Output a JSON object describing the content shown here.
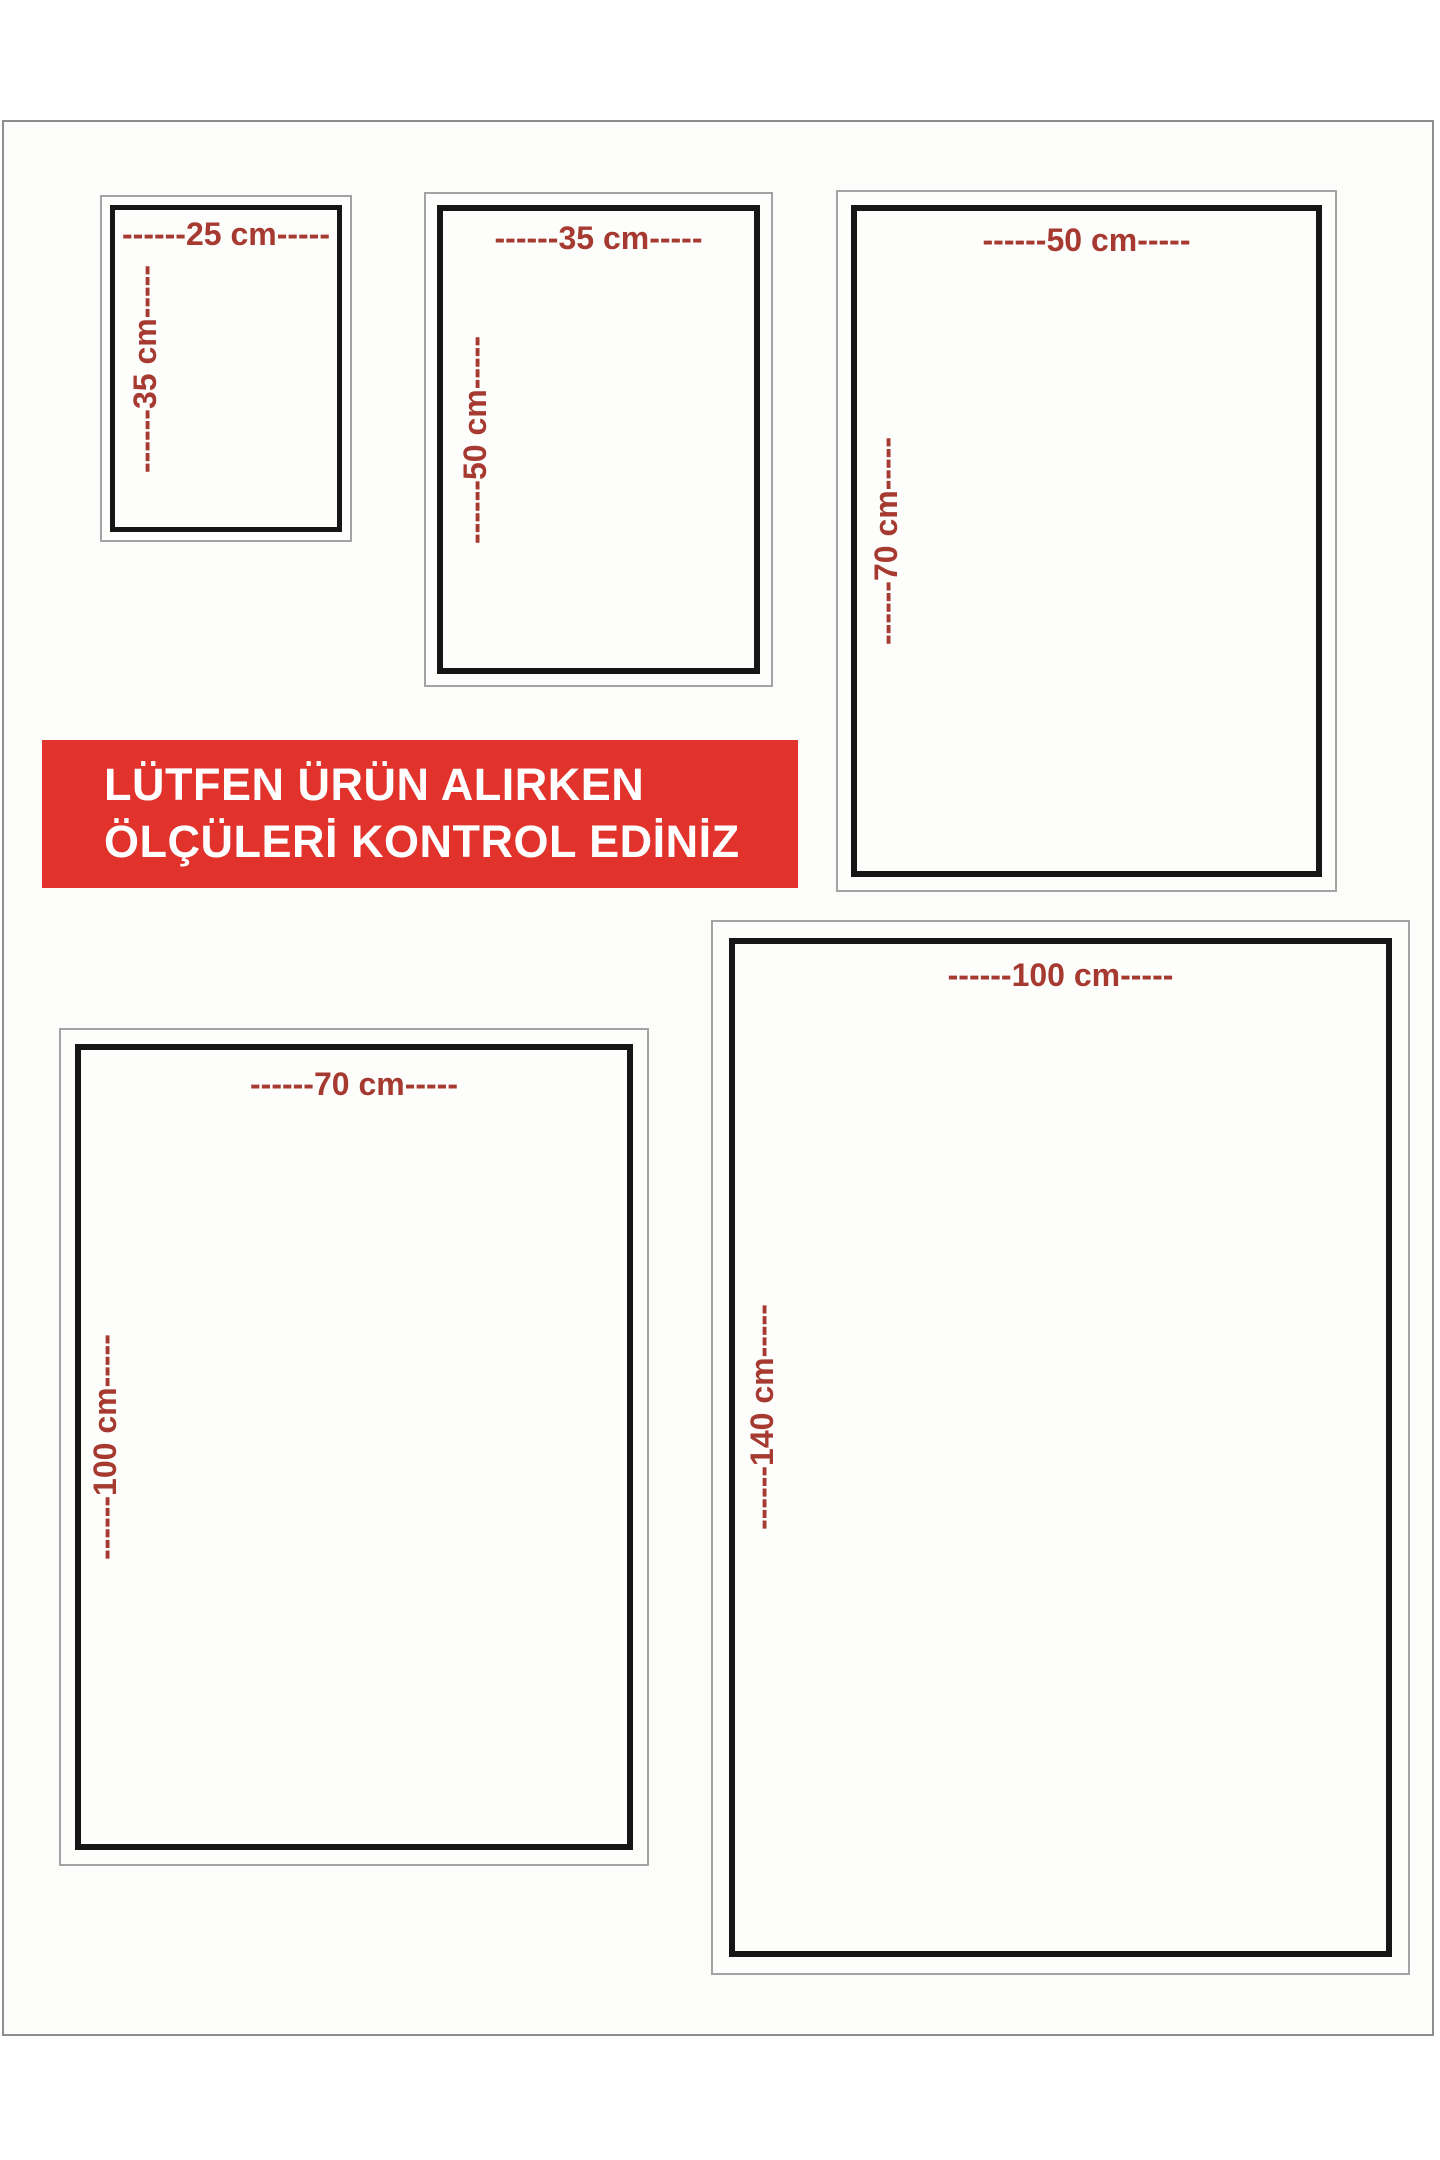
{
  "banner": {
    "line1": "LÜTFEN ÜRÜN ALIRKEN",
    "line2": "ÖLÇÜLERİ KONTROL EDİNİZ"
  },
  "colors": {
    "banner_bg": "#e1332c",
    "banner_text": "#ffffff",
    "dimension_label": "#a63a31",
    "inner_frame_border": "#161616",
    "outer_frame_border": "#a3a3a3"
  },
  "sizes": [
    {
      "name": "25x35 cm",
      "width_label": "------25 cm-----",
      "height_label": "------35 cm-----"
    },
    {
      "name": "35x50 cm",
      "width_label": "------35 cm-----",
      "height_label": "------50 cm-----"
    },
    {
      "name": "50x70 cm",
      "width_label": "------50 cm-----",
      "height_label": "------70 cm-----"
    },
    {
      "name": "70x100 cm",
      "width_label": "------70 cm-----",
      "height_label": "------100 cm-----"
    },
    {
      "name": "100x140 cm",
      "width_label": "------100 cm-----",
      "height_label": "------140 cm-----"
    }
  ]
}
